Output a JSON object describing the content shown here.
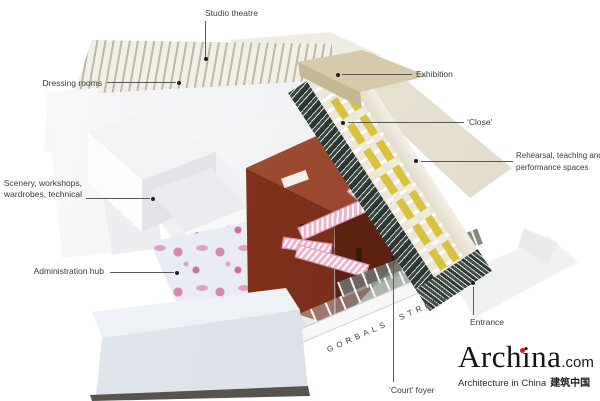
{
  "canvas": {
    "width": 600,
    "height": 401,
    "background": "#ffffff"
  },
  "annotations": {
    "studio_theatre": "Studio theatre",
    "dressing_rooms": "Dressing rooms",
    "exhibition": "Exhibition",
    "close": "‘Close’",
    "rehearsal_line1": "Rehearsal, teaching and",
    "rehearsal_line2": "performance spaces",
    "scenery_line1": "Scenery, workshops,",
    "scenery_line2": "wardrobes, technical",
    "administration": "Administration hub",
    "entrance": "Entrance",
    "court_foyer": "‘Court’ foyer",
    "street_name": "GORBALS STREET"
  },
  "logo": {
    "brand": "Archina",
    "domain": ".com",
    "tagline": "Architecture in China",
    "tagline_cjk": "建筑中国",
    "accent_color": "#c9201d"
  },
  "colors": {
    "label_text": "#3c3c3c",
    "leader_line": "#5a5a5a",
    "brick_red": "#82331d",
    "ramp_pink": "#efb3cd",
    "floral_pink": "#d787ae",
    "rehearsal_yellow": "#d9c240",
    "exhibition_beige": "#d7c9ab",
    "street_grey": "#9aa095",
    "collage_dark": "#2e3a36"
  }
}
